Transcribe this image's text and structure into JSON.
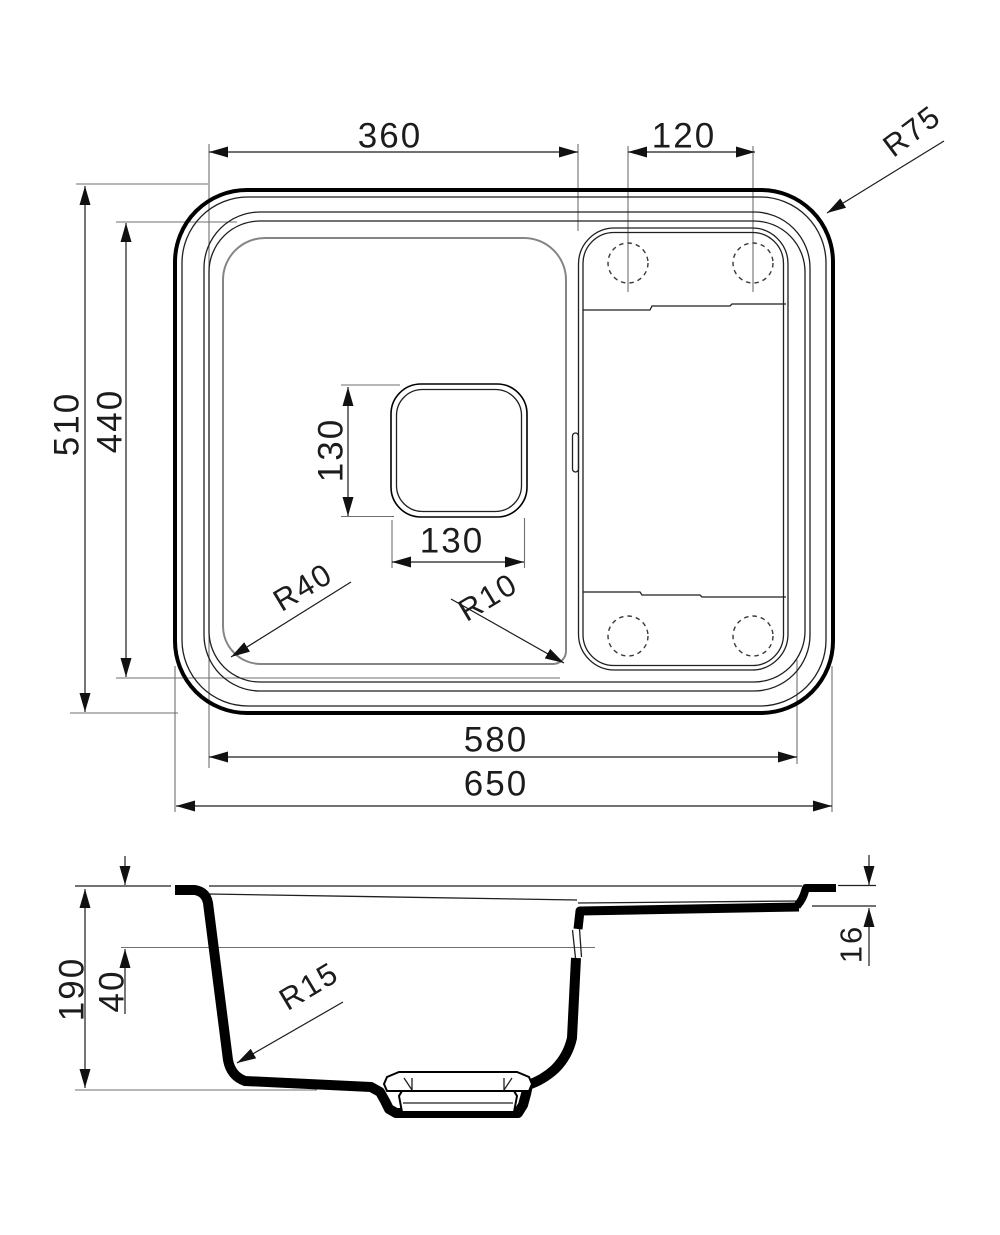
{
  "drawing": {
    "top_view": {
      "dim_bowl_inner_width": "360",
      "dim_tap_hole_spacing": "120",
      "corner_radius": "R75",
      "dim_overall_depth": "510",
      "dim_inner_depth": "440",
      "dim_drain_square_height": "130",
      "dim_drain_square_width": "130",
      "bowl_corner_radius": "R40",
      "bowl_inner_corner_radius": "R10",
      "dim_inner_width": "580",
      "dim_overall_width": "650"
    },
    "section_view": {
      "dim_total_height": "190",
      "dim_drainboard_drop": "40",
      "bowl_bottom_radius": "R15",
      "dim_rim_edge_height": "16"
    },
    "colors": {
      "primary_line": "#000000",
      "secondary_line": "#858585",
      "background": "#ffffff"
    }
  }
}
